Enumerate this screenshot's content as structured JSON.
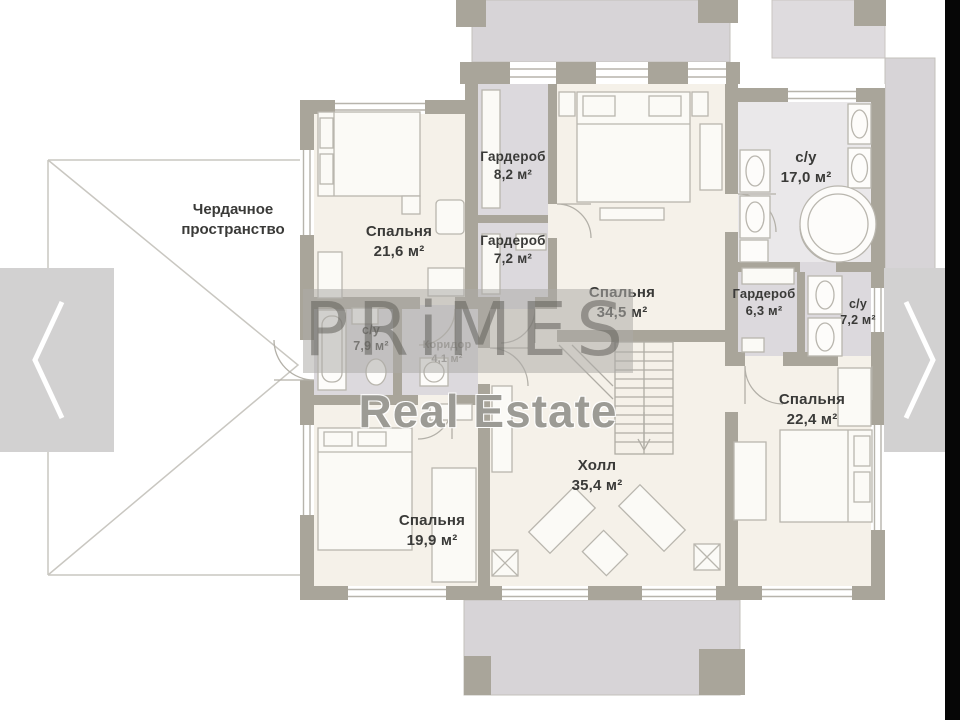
{
  "attic_label": "Чердачное пространство",
  "rooms": [
    {
      "id": "bedroom-21-6",
      "name": "Спальня",
      "area": "21,6 м²"
    },
    {
      "id": "wardrobe-8-2",
      "name": "Гардероб",
      "area": "8,2 м²"
    },
    {
      "id": "wardrobe-7-2",
      "name": "Гардероб",
      "area": "7,2 м²"
    },
    {
      "id": "bedroom-34-5",
      "name": "Спальня",
      "area": "34,5 м²"
    },
    {
      "id": "bathroom-17-0",
      "name": "с/у",
      "area": "17,0 м²"
    },
    {
      "id": "wardrobe-6-3",
      "name": "Гардероб",
      "area": "6,3 м²"
    },
    {
      "id": "bathroom-7-2",
      "name": "с/у",
      "area": "7,2 м²"
    },
    {
      "id": "bedroom-22-4",
      "name": "Спальня",
      "area": "22,4 м²"
    },
    {
      "id": "hall-35-4",
      "name": "Холл",
      "area": "35,4 м²"
    },
    {
      "id": "bedroom-19-9",
      "name": "Спальня",
      "area": "19,9 м²"
    },
    {
      "id": "bathroom-7-9",
      "name": "с/у",
      "area": "7,9 м²"
    },
    {
      "id": "corridor-4-1",
      "name": "Коридор",
      "area": "4,1 м²"
    }
  ],
  "watermark": {
    "brand": "PRiMES",
    "subtitle": "Real Estate"
  },
  "colors": {
    "wall": "#a9a59a",
    "floor": "#f5f1e9",
    "wet_floor": "#dcd9dd",
    "terrace": "#d7d4d7",
    "arrow_overlay": "#d2d1d1",
    "letterbox_bar": "#060606"
  }
}
